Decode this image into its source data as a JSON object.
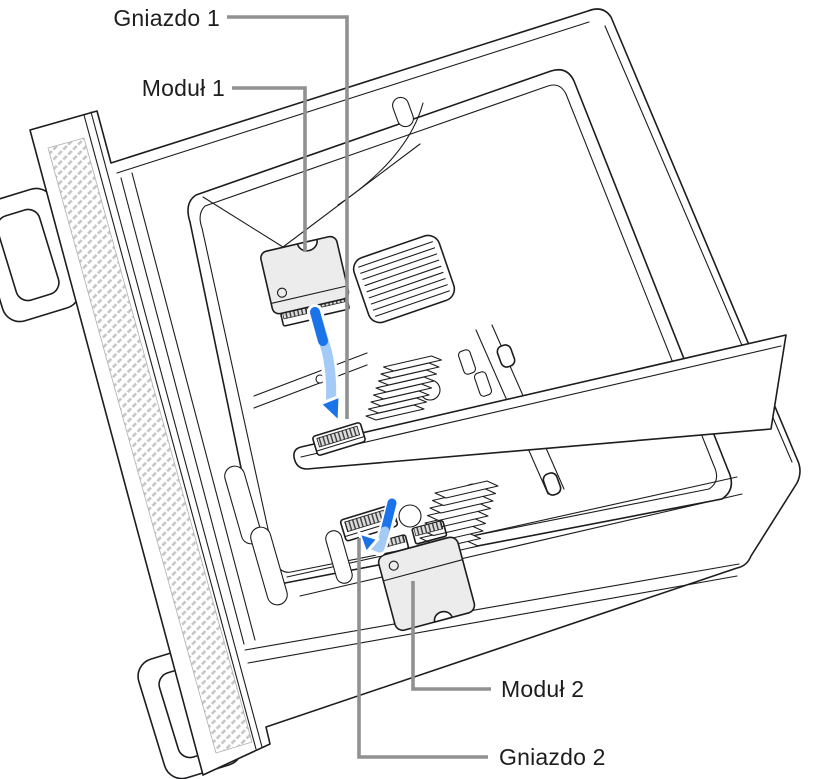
{
  "figure": {
    "labels": {
      "slot1": "Gniazdo 1",
      "module1": "Moduł 1",
      "module2": "Moduł 2",
      "slot2": "Gniazdo 2"
    },
    "colors": {
      "line": "#1d1d1f",
      "leader": "#919191",
      "arrow_dark": "#1a73e8",
      "arrow_light": "#a3cbf5",
      "module_fill": "#ececec",
      "hatch": "#c6c6c6",
      "background": "#ffffff"
    }
  }
}
